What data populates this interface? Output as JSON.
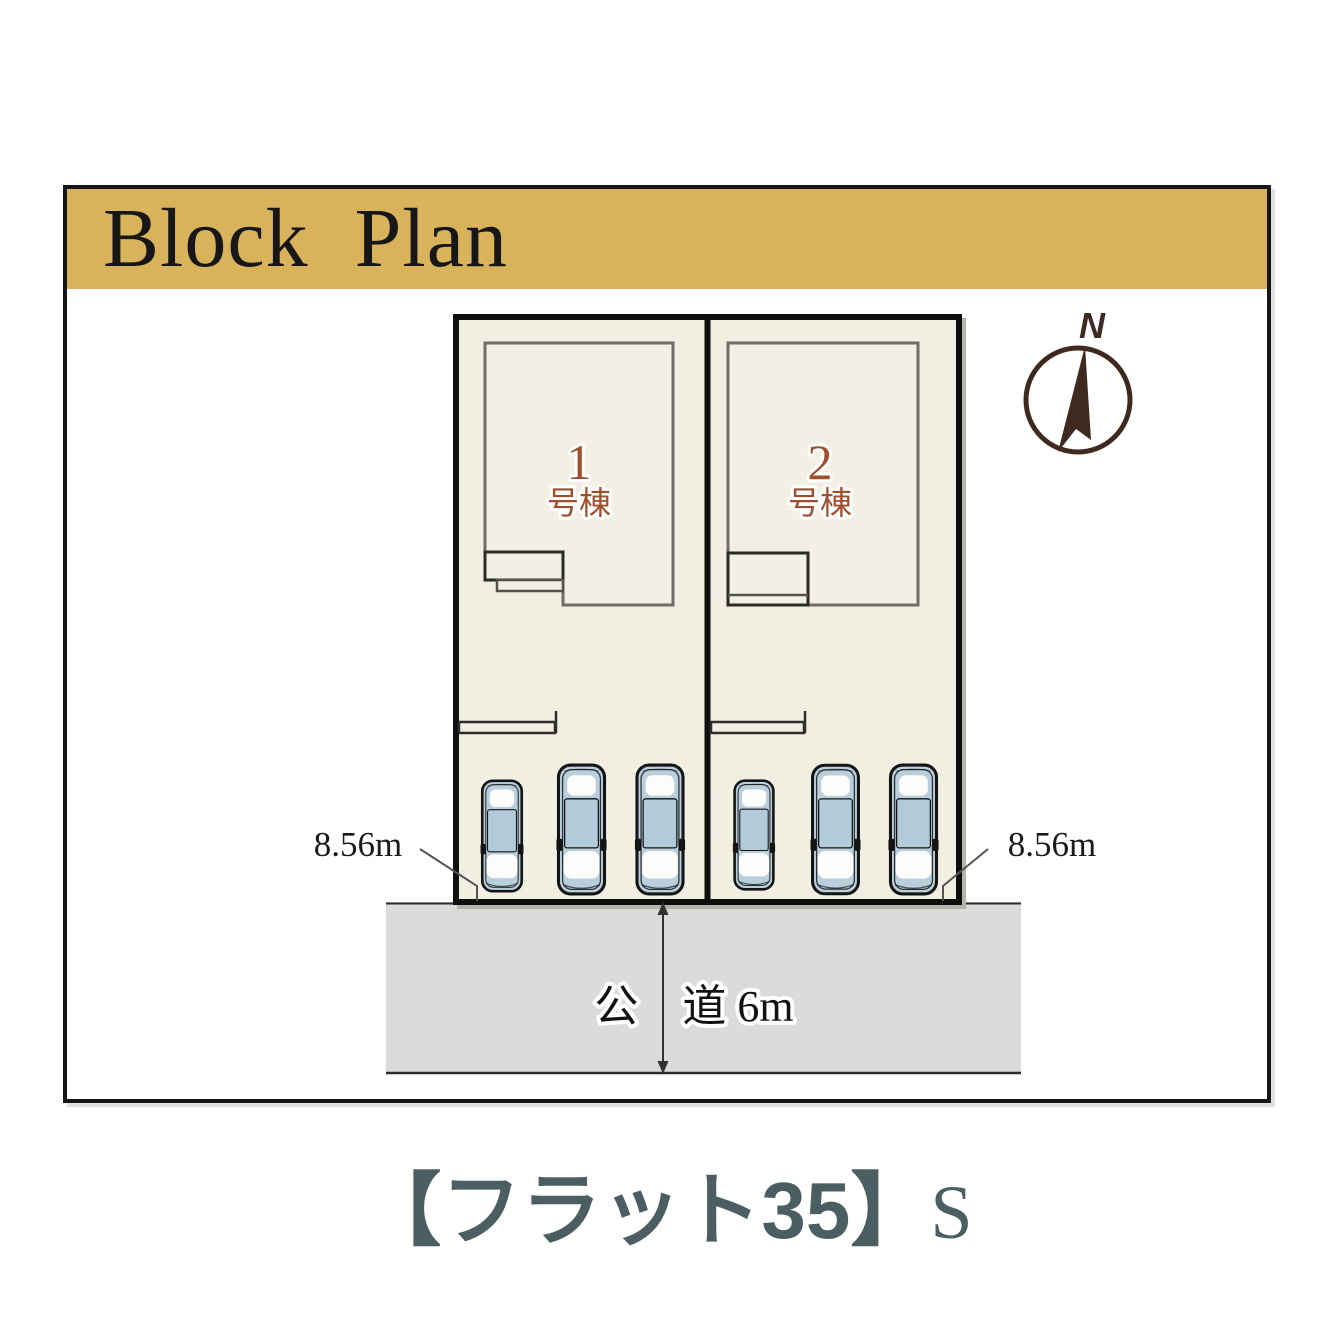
{
  "header": {
    "title": "Block Plan"
  },
  "site": {
    "units": [
      {
        "number": "1",
        "suffix": "号棟"
      },
      {
        "number": "2",
        "suffix": "号棟"
      }
    ],
    "frontage_dimensions": {
      "left": "8.56m",
      "right": "8.56m"
    },
    "road": {
      "label": "公　道 6m"
    },
    "compass": {
      "north_label": "N"
    },
    "parking": {
      "cars_lot1": 3,
      "cars_lot2": 3
    }
  },
  "footer": {
    "logo_main": "【フラット35】",
    "logo_suffix": "S"
  },
  "colors": {
    "band_gold": "#D9B25C",
    "lot_cream": "#F1EEE2",
    "building_fill": "#F2EFE4",
    "brick_text": "#9F4E2E",
    "car_blue": "#B9CFDC",
    "road_gray": "#DBDBDB",
    "compass_brown": "#3F2A22",
    "logo_teal": "#4B5F63"
  }
}
